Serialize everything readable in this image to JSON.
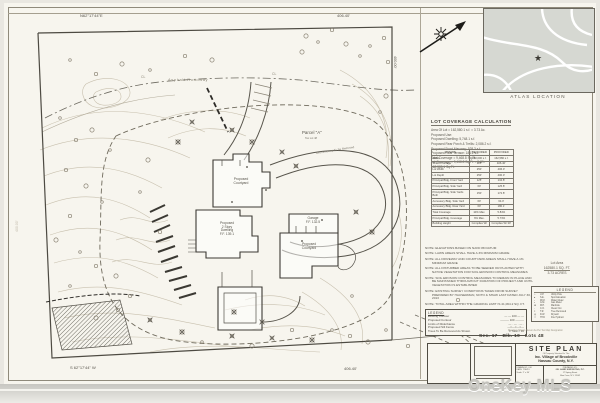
{
  "plan": {
    "bearing_top": "N62°17'44\"E",
    "dim_top": "406.40'",
    "dim_right": "400.00'",
    "dim_left": "400.00'",
    "bearing_bottom": "S 62°17'44\" W",
    "dim_bottom": "406.40'",
    "road_label": "Asphalt Roadway",
    "cl_left": "CL",
    "cl_right": "CL",
    "parcel_label": "Parcel \"A\"",
    "tax_lot": "Tax Lot 48",
    "courtyard_upper_l1": "Proposed",
    "courtyard_upper_l2": "Courtyard",
    "dwelling_l1": "Proposed",
    "dwelling_l2": "2 Story",
    "dwelling_l3": "Dwelling",
    "dwelling_l4": "F.F. 139.1",
    "garage_l1": "Garage",
    "garage_l2": "F.F. 132.5",
    "courtyard_lower_l1": "Proposed",
    "courtyard_lower_l2": "Courtyard",
    "dirt_drive": "Dirt Driveway To Be Removed"
  },
  "atlas": {
    "label": "ATLAS LOCATION"
  },
  "coverage": {
    "title": "LOT COVERAGE CALCULATION",
    "intro_lines": [
      "Area Of Lot = 162,580.1 s.f. = 3.73 Ac.",
      "Proposed Use:",
      "Proposed Dwelling:  5,748.1 s.f.",
      "Proposed Rear Porch & Trellis:  2,086.2 s.f.",
      "Proposed Front Masonry:  528.3 s.f.",
      "Proposed Rear Terrace:  186.2 s.f.",
      "Total Coverage = 9,468.8 Sq.Ft.",
      "Lot Coverage =  9,468.8 Sq.Ft.  = 5.8%",
      "                162,580.1 Sq.Ft."
    ],
    "table": {
      "headers": [
        "ZONING",
        "REQUIRED",
        "PROVIDED"
      ],
      "rows": [
        [
          "AREA",
          "160,000 s.f.",
          "162,580 s.f."
        ],
        [
          "Street Frontage",
          "125'",
          "406.40'"
        ],
        [
          "Lot Width",
          "250'",
          "406.0'"
        ],
        [
          "Lot Depth",
          "250'",
          "400.0'"
        ],
        [
          "Principal Bldg. Front Yard",
          "125'",
          "134.8'"
        ],
        [
          "Principal Bldg. Side Yard",
          "60'",
          "125.8'"
        ],
        [
          "Principal Bldg. Side Yards Both",
          "150'",
          "172.8'"
        ],
        [
          "Accessory Bldg. Side Yard",
          "60'",
          "64.0'"
        ],
        [
          "Accessory Bldg. Rear Yard",
          "60'",
          "180.1'"
        ],
        [
          "Total Coverage",
          "10% Max.",
          "5.84%"
        ],
        [
          "Principal Bldg. Coverage",
          "6% Max.",
          "5.73%"
        ],
        [
          "Building Height",
          "Complies W/",
          "Complies W/ 30'"
        ]
      ]
    }
  },
  "lot_area": {
    "l1": "Lot Area",
    "l2": "162580.1 SQ. FT.",
    "l3": "3.73 ACRES"
  },
  "notes": [
    "NOTE: ELEVATIONS BASED ON NAVD 88 DATUM",
    "NOTE: LAWN AREAS SHALL HAVE A 3% MINIMUM GRADE",
    "NOTE: ALL DRIVEWAY AND COURTYARD AREAS SHALL HAVE A 1% MINIMUM GRADE",
    "NOTE: ALL DISTURBED AREAS TO BE SEEDED OR PLANTED WITH NATIVE VEGETATION FOR SOIL EROSION CONTROL MEASURES",
    "NOTE: SOIL EROSION CONTROL MEASURES TO REMAIN IN PLACE AND BE MAINTAINED THROUGHOUT DURATION OF PROJECT AND UNTIL VEGETATION IS ESTABLISHED",
    "NOTE: EXISTING SURVEY CONDITIONS TAKEN FROM SURVEY PREPARED BY HAUSERMAN, NOTO & SHAW LAST DATED JULY 30, 2013",
    "NOTE: TOTAL AREA WITHIN THE GRADING LIMIT IS 41,064.2 SQ. FT."
  ],
  "legend_symbols": {
    "title": "LEGEND",
    "rows": [
      [
        "○",
        "U.P.",
        "Utility Pole"
      ],
      [
        "●",
        "S.E.",
        "Spot Elevation"
      ],
      [
        "▫",
        "W.M.",
        "Water Meter"
      ],
      [
        "▪",
        "G.M.",
        "Gas Meter"
      ],
      [
        "⊕",
        "M.H.",
        "Manhole"
      ],
      [
        "◦",
        "C.O.",
        "Clean Out"
      ],
      [
        "×",
        "T.R.",
        "Tree Removed"
      ],
      [
        "◎",
        "D.W.",
        "Drywell"
      ],
      [
        "☆",
        "HYD",
        "Fire Hydrant"
      ]
    ]
  },
  "legend_lines": {
    "title": "LEGEND",
    "rows": [
      {
        "label": "Existing Contour",
        "sample": "— — 100 — —"
      },
      {
        "label": "Proposed Contour",
        "sample": "——— 100 ———"
      },
      {
        "label": "Limits of Disturbance",
        "sample": "— · — · — ·"
      },
      {
        "label": "Proposed Silt Fence",
        "sample": "—×—×—×—"
      },
      {
        "label": "Trees To Be Removed As Shown",
        "sample": "X Total = 36"
      }
    ]
  },
  "cert_line": "Premises Shown Hereon As Per Tax Map Designation",
  "section_line": "Sec. 17   Blk. 10   Lots 48",
  "title_block": {
    "title": "SITE PLAN",
    "sub": "Of Property Situated In The",
    "line1": "Inc. Village of Brookville",
    "line2": "Nassau County, N.Y.",
    "drawn": "DRAWN BY: J.M.",
    "date": "DATE: 7/30/13",
    "scale": "Scale: 1\" = 30'",
    "prep1": "PREPARED BY:",
    "prep2": "J.B. LAND SURVEYING, P.C.",
    "prep3": "17 Spring Street",
    "prep4": "Glen Cove, N.Y. 11542"
  },
  "watermark": "OneKey MLS"
}
